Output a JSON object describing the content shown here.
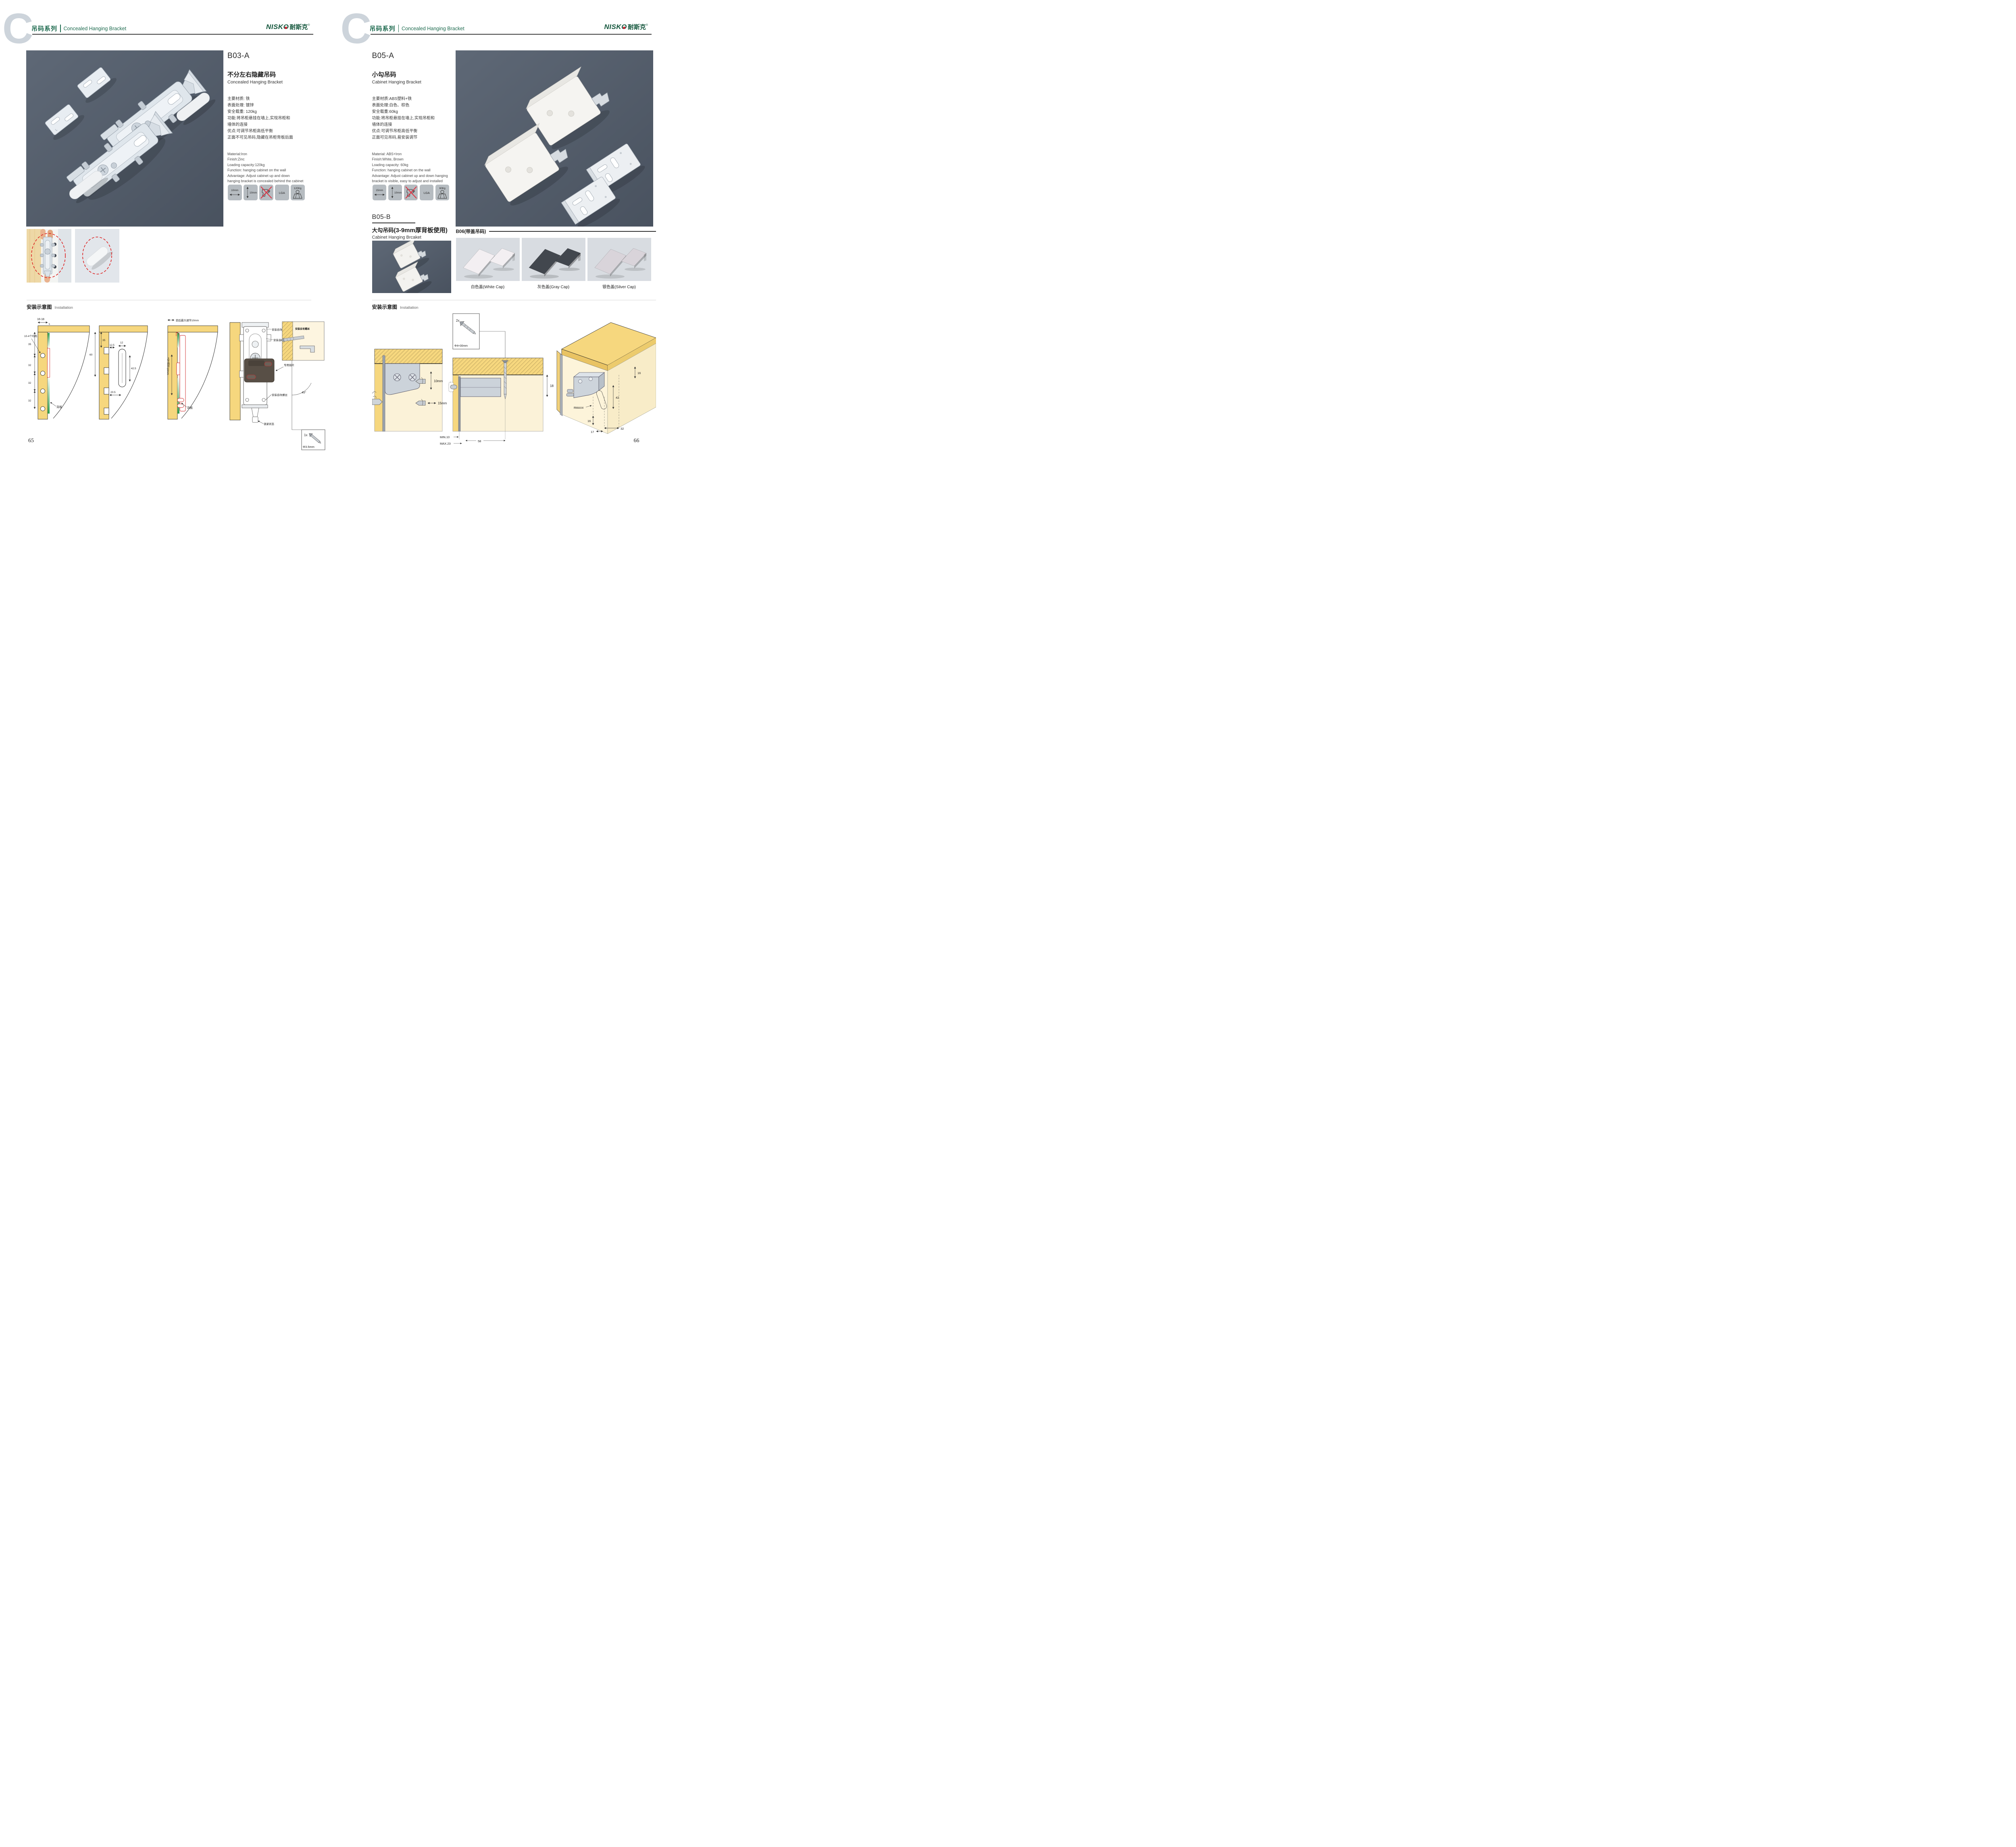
{
  "brand": {
    "logo_en": "NISKO",
    "logo_cn": "耐斯克",
    "registered": "®"
  },
  "header": {
    "letter": "C",
    "series_cn": "吊码系列",
    "series_en": "Concealed Hanging Bracket"
  },
  "left_page": {
    "page_number": "65",
    "product": {
      "code": "B03-A",
      "name_cn": "不分左右隐藏吊码",
      "name_en": "Concealed Hanging Bracket",
      "specs_cn": [
        "主要材质: 铁",
        "表面处理: 镀锌",
        "安全载重: 120kg",
        "功能:将吊柜悬挂在墙上,实现吊柜和",
        "墙体的连接",
        "优点:可调节吊柜高低平衡",
        "正面不可见吊码,隐藏在吊柜背板后面"
      ],
      "specs_en": [
        "Material:Iron",
        "Finish:Zinc",
        "Loading capacity:120kg",
        "Function: hanging cabinet on the wall",
        "Advantage: Adjust cabinet up and down",
        "hanging bracket is concealed behind the cabinet"
      ],
      "icons": [
        {
          "name": "width-adjust-icon",
          "label": "10mm"
        },
        {
          "name": "height-adjust-icon",
          "label": "10mm"
        },
        {
          "name": "no-drill-icon"
        },
        {
          "name": "lga-cert-icon",
          "label": "LGA"
        },
        {
          "name": "load-capacity-icon",
          "label": "120Kg"
        }
      ]
    },
    "installation": {
      "title_cn": "安装示意图",
      "title_en": "Installation",
      "d1": {
        "dim_top": "16-18",
        "dim_gap": "5",
        "dim_35": "35",
        "dim_32a": "32",
        "dim_32b": "32",
        "dim_32c": "32",
        "label_holes": "10-4个均布",
        "label_back": "背板"
      },
      "d2": {
        "dim_60": "60",
        "dim_35": "35",
        "dim_125": "12.5",
        "dim_12": "12",
        "dim_425": "42.5",
        "dim_205": "20.5"
      },
      "d3": {
        "label_top": "前后最大调节10mm",
        "label_side": "上下调节10mm",
        "label_back": "背板"
      },
      "d4": {
        "label_screw_top": "安装自攻螺丝",
        "label_screw_mid": "安装自攻螺丝",
        "label_plate": "专用挂片",
        "label_screw_low": "安装自攻螺丝",
        "label_lock": "锁紧状态",
        "inset_label": "安装自攻螺丝",
        "angle": "45°",
        "screw_qty": "1x",
        "screw_size": "Φ3.5mm"
      }
    }
  },
  "right_page": {
    "page_number": "66",
    "product_a": {
      "code": "B05-A",
      "name_cn": "小勾吊码",
      "name_en": "Cabinet Hanging Bracket",
      "specs_cn": [
        "主要材质:ABS塑料+铁",
        "表面处理:白色、棕色",
        "安全载重:60kg",
        "功能:将吊柜悬挂在墙上,实现吊柜和",
        "墙体的连接",
        "优点:可调节吊柜高低平衡",
        "正面可见吊码,易安装调节"
      ],
      "specs_en": [
        "Material: ABS+Iron",
        "Finish:White, Brown",
        "Loading capacity: 60kg",
        "Function: hanging cabinet on the wall",
        "Advantage: Adjust cabinet up and down hanging",
        "bracket is visible, easy to adjust and installed"
      ],
      "icons": [
        {
          "name": "width-adjust-icon",
          "label": "15mm"
        },
        {
          "name": "height-adjust-icon",
          "label": "10mm"
        },
        {
          "name": "no-drill-icon"
        },
        {
          "name": "lga-cert-icon",
          "label": "LGA"
        },
        {
          "name": "load-capacity-icon",
          "label": "60Kg"
        }
      ]
    },
    "product_b": {
      "code": "B05-B",
      "name_cn": "大勾吊码",
      "name_cn_note": "(3-9mm厚背板使用)",
      "name_en": "Cabinet Hanging Brcaket"
    },
    "b06": {
      "title": "B06(带盖吊码)",
      "caps": [
        {
          "label": "白色盖(White Cap)",
          "color": "#f3eff2"
        },
        {
          "label": "灰色盖(Gray Cap)",
          "color": "#42474e"
        },
        {
          "label": "银色盖(Silver Cap)",
          "color": "#d9d4da"
        }
      ]
    },
    "installation": {
      "title_cn": "安装示意图",
      "title_en": "Installation",
      "d1": {
        "dim_v": "10mm",
        "dim_h": "15mm"
      },
      "screwbox": {
        "qty": "2x",
        "size": "Φ4×30mm"
      },
      "d2": {
        "dim_18": "18",
        "dim_min": "MIN.10",
        "dim_max": "MAX.23",
        "dim_58": "58"
      },
      "d3": {
        "dim_16_top": "16",
        "dim_42": "42",
        "dim_rmax": "RMAX4",
        "dim_16_bot": "16",
        "dim_17": "17",
        "dim_32": "32"
      }
    }
  }
}
